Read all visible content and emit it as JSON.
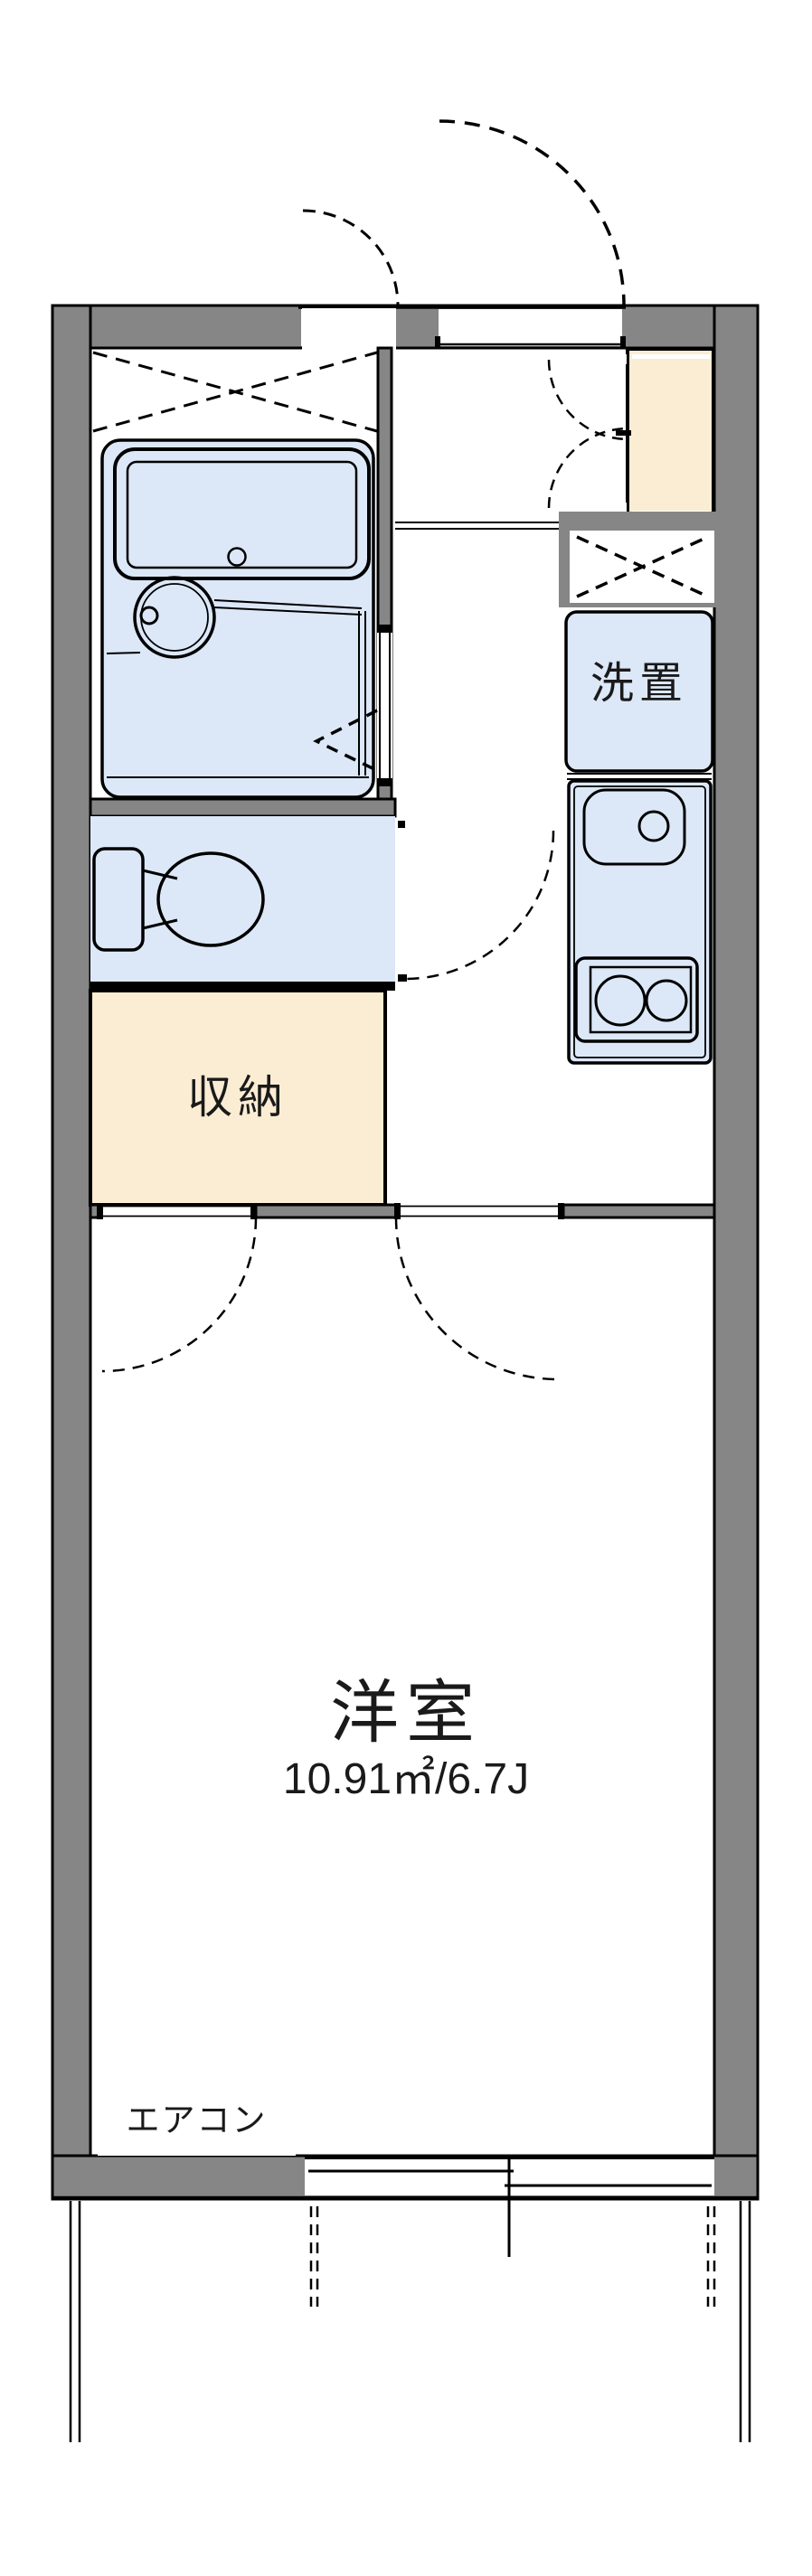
{
  "colors": {
    "wall": "#868686",
    "wet_room": "#dce8f7",
    "storage": "#fbedd3",
    "white": "#ffffff"
  },
  "rooms": {
    "western_room": {
      "label": "洋室",
      "area": "10.91㎡/6.7J"
    },
    "storage_closet": {
      "label": "収納"
    },
    "washer_space": {
      "label": "洗置"
    },
    "air_conditioner": {
      "label": "エアコン"
    }
  }
}
